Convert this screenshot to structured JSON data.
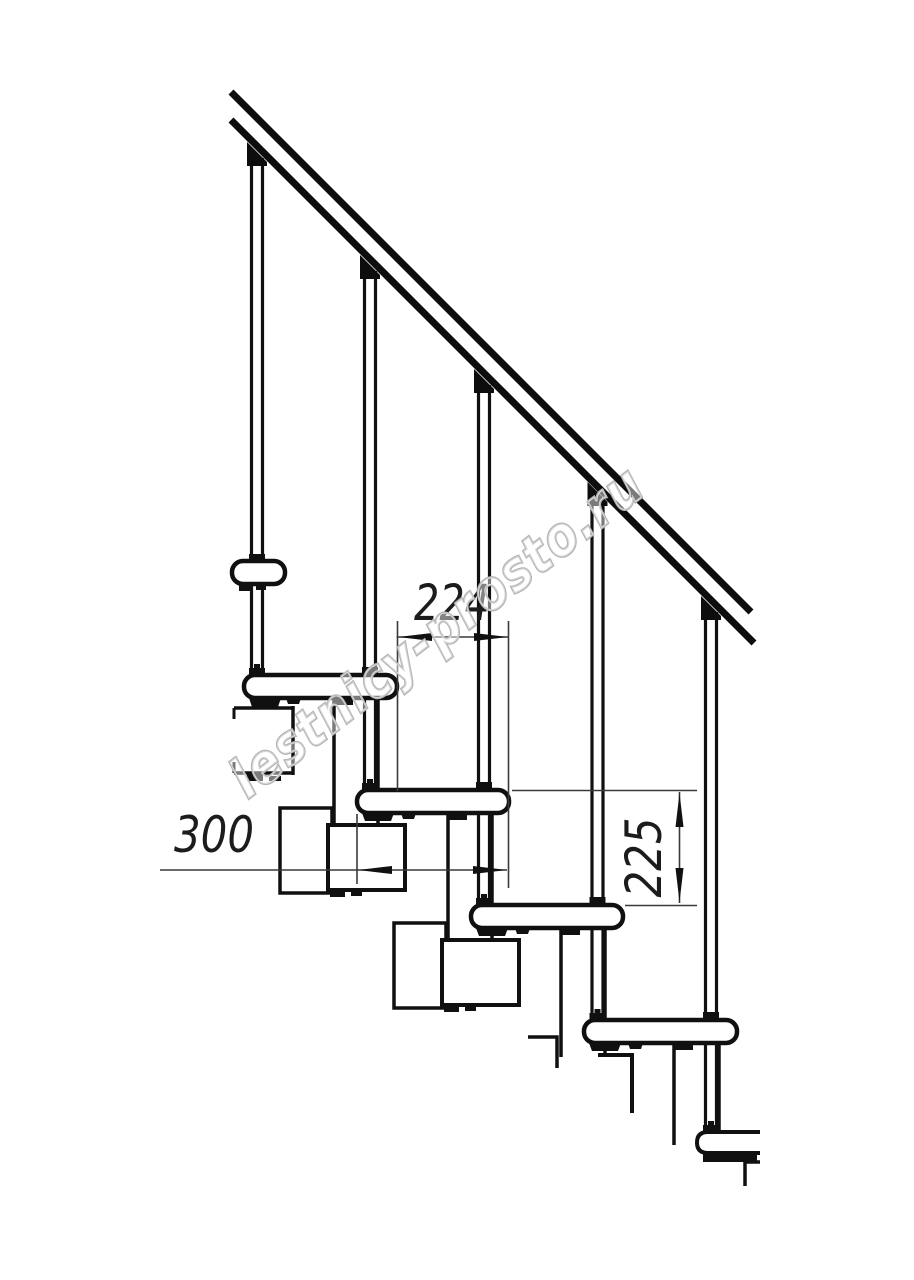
{
  "drawing": {
    "kind": "modular staircase side elevation, technical line drawing",
    "dimensions": {
      "run": "224",
      "tread_length": "300",
      "rise": "225"
    },
    "watermark": {
      "text": "lestnicy-prosto.ru"
    },
    "colors": {
      "background": "#ffffff",
      "outline": "#101010",
      "dimension_lines": "#3a3a3a",
      "watermark_stroke": "#b4b4b4"
    }
  }
}
